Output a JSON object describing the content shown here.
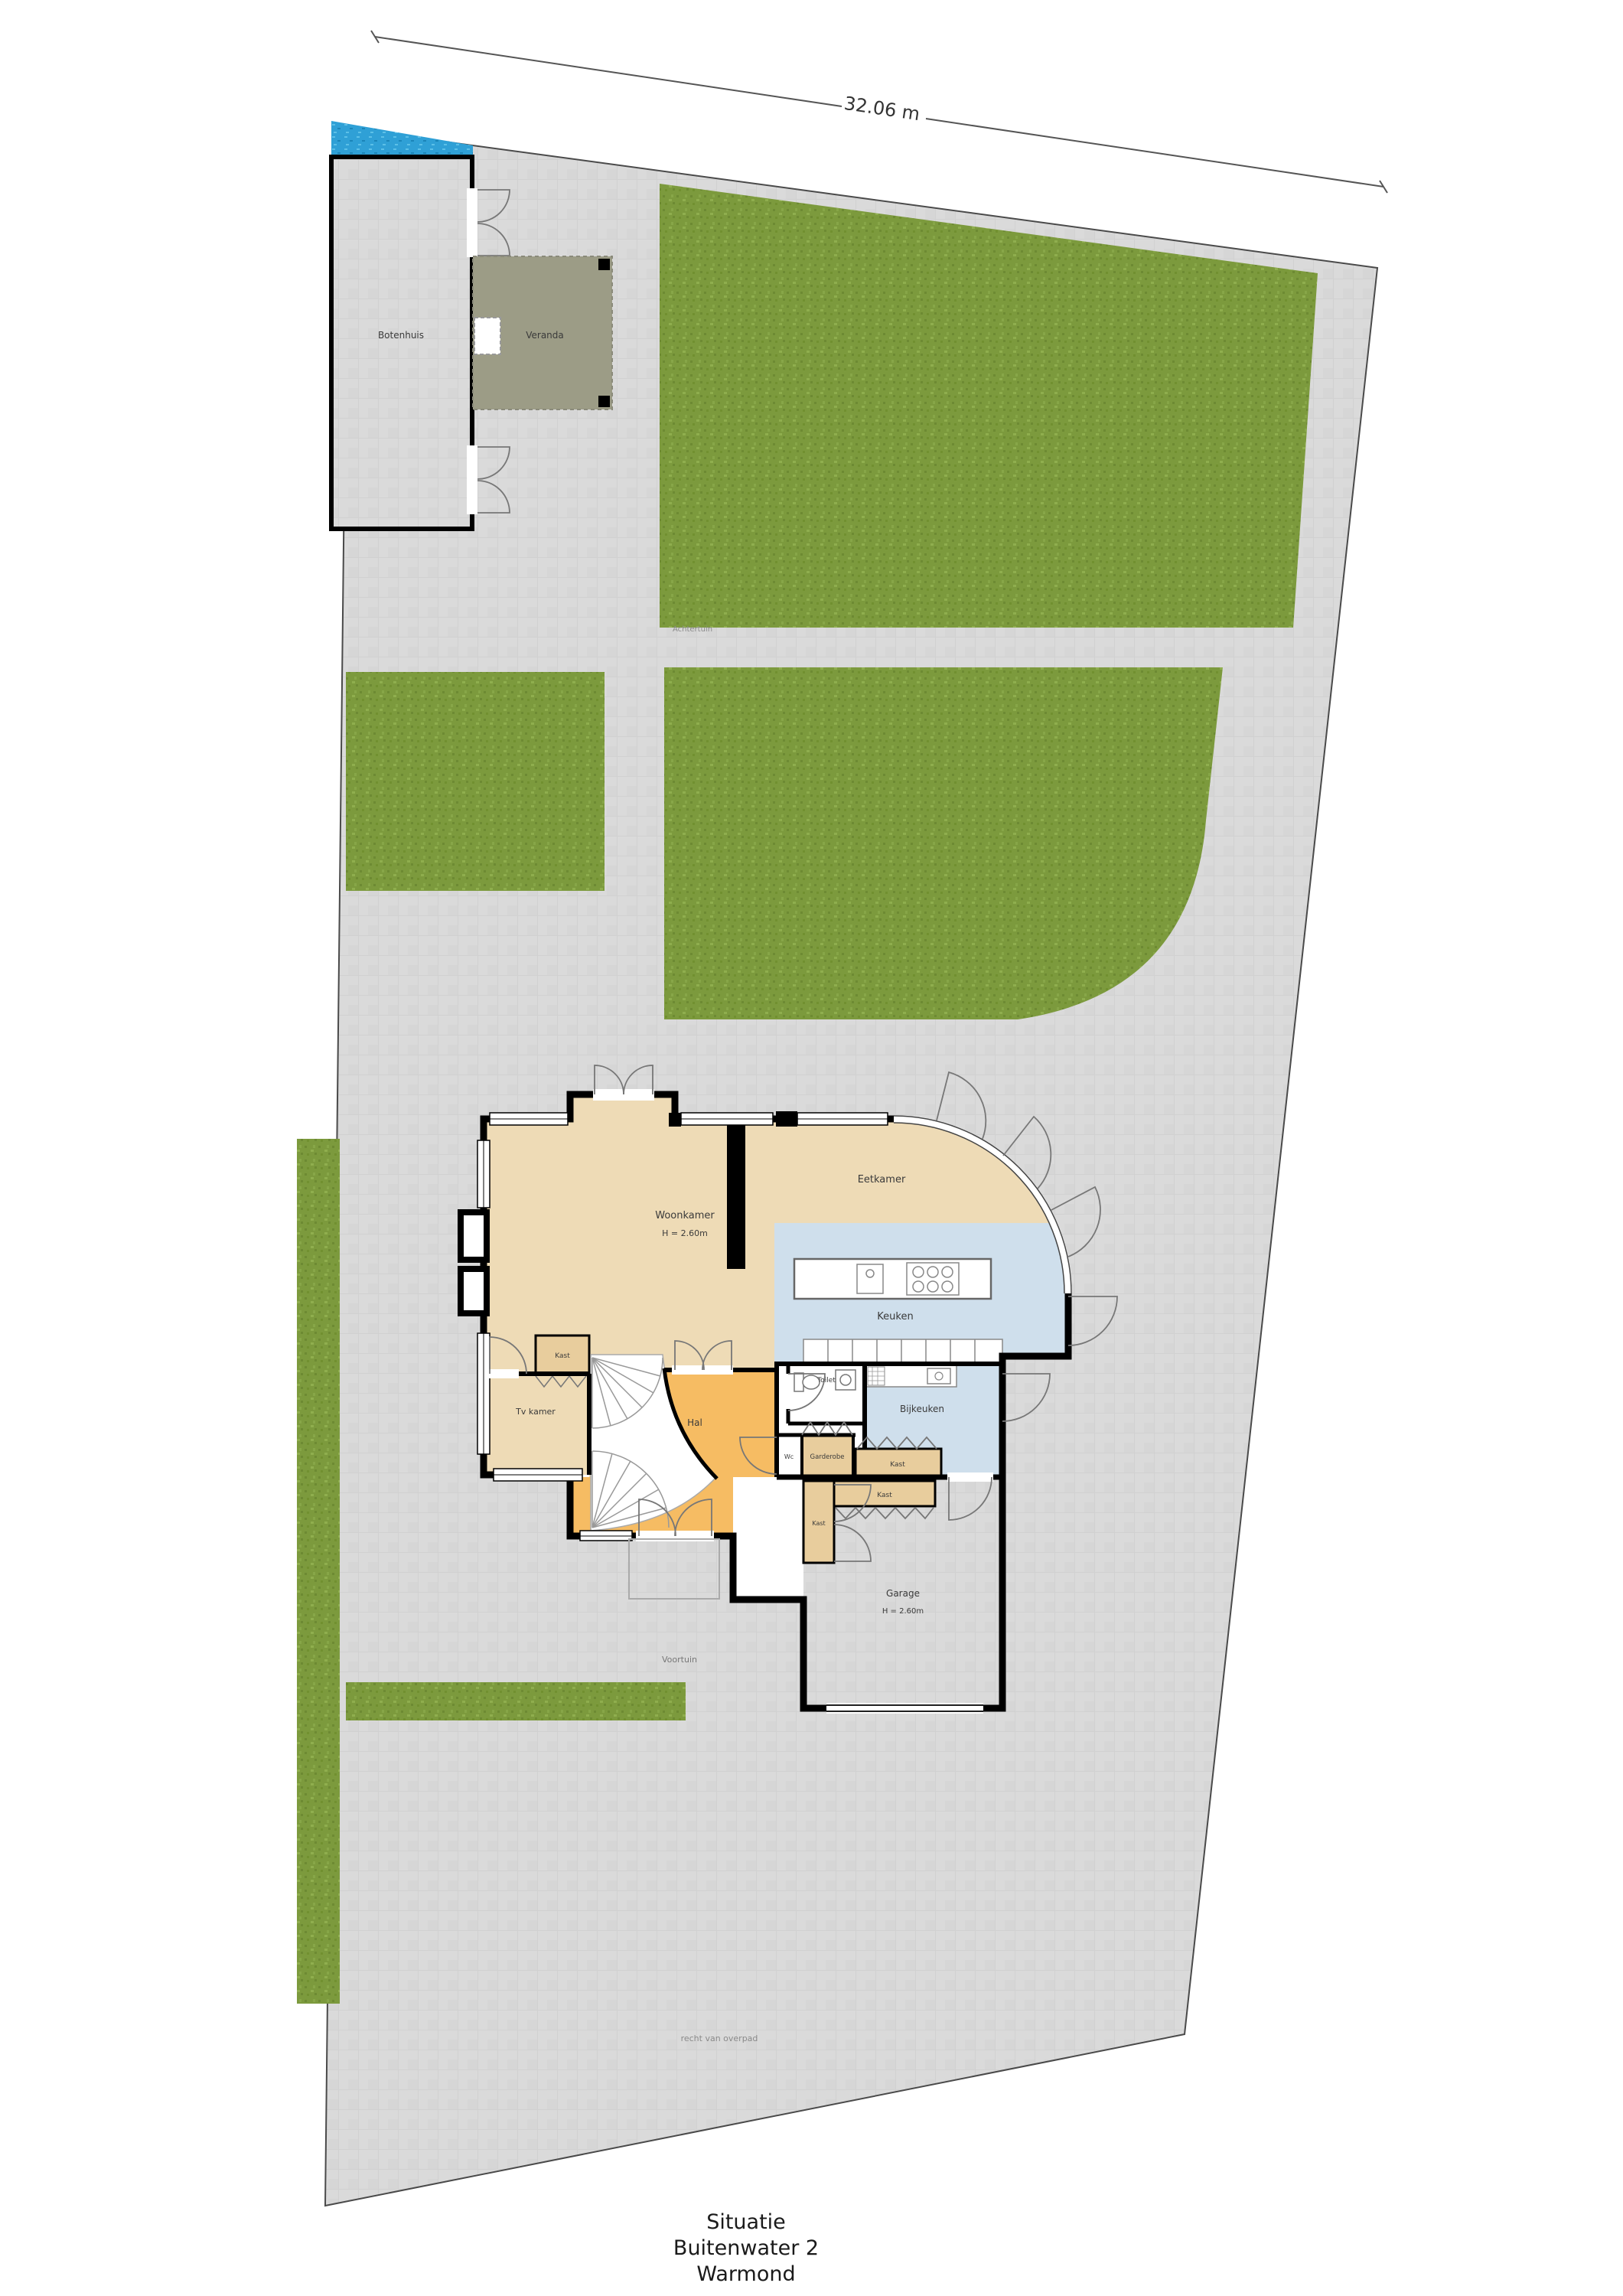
{
  "dimension": {
    "length_label": "32.06 m"
  },
  "outbuilding": {
    "botenhuis": "Botenhuis",
    "veranda": "Veranda"
  },
  "garden": {
    "achtertuin": "Achtertuin",
    "voortuin": "Voortuin",
    "easement": "recht van overpad"
  },
  "house": {
    "woonkamer": "Woonkamer",
    "woonkamer_height": "H = 2.60m",
    "eetkamer": "Eetkamer",
    "keuken": "Keuken",
    "bijkeuken": "Bijkeuken",
    "toilet": "Toilet",
    "wc": "Wc",
    "hal": "Hal",
    "tv_kamer": "Tv kamer",
    "garderobe": "Garderobe",
    "kast": "Kast",
    "garage": "Garage",
    "garage_height": "H = 2.60m"
  },
  "title": {
    "line1": "Situatie",
    "line2": "Buitenwater 2",
    "line3": "Warmond"
  },
  "colors": {
    "paving": "#d9d9d9",
    "grass": "#7c9a3d",
    "water": "#2fa0d6",
    "living_tan": "#eedbb6",
    "hall_orange": "#f6bc63",
    "kitchen_blue": "#cfdfec",
    "closet_tan": "#e8cd9d",
    "veranda_olive": "#9c9c86",
    "garage_gray": "#d7d7d7"
  }
}
